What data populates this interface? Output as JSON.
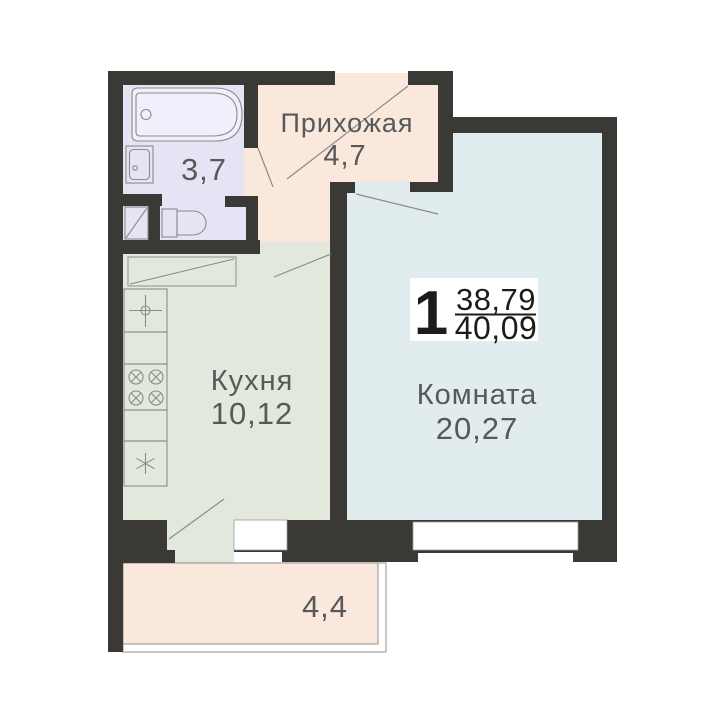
{
  "colors": {
    "wall": "#3b3936",
    "bathroom": "#e4e4f4",
    "hallway": "#f9e8db",
    "kitchen": "#e2e9dc",
    "room": "#e1ecee",
    "balcony": "#f9e8db",
    "tub_fill": "#eff0fb",
    "window": "#ffffff",
    "fixture_stroke": "#8b8b89",
    "label_text": "#58585a",
    "badge_bg": "#ffffff",
    "badge_text": "#1c1c1a"
  },
  "badge": {
    "rooms_count": "1",
    "area_living": "38,79",
    "area_total": "40,09"
  },
  "rooms": {
    "hallway": {
      "label": "Прихожая",
      "area": "4,7"
    },
    "bathroom": {
      "area": "3,7"
    },
    "kitchen": {
      "label": "Кухня",
      "area": "10,12"
    },
    "living": {
      "label": "Комната",
      "area": "20,27"
    },
    "balcony": {
      "area": "4,4"
    }
  }
}
